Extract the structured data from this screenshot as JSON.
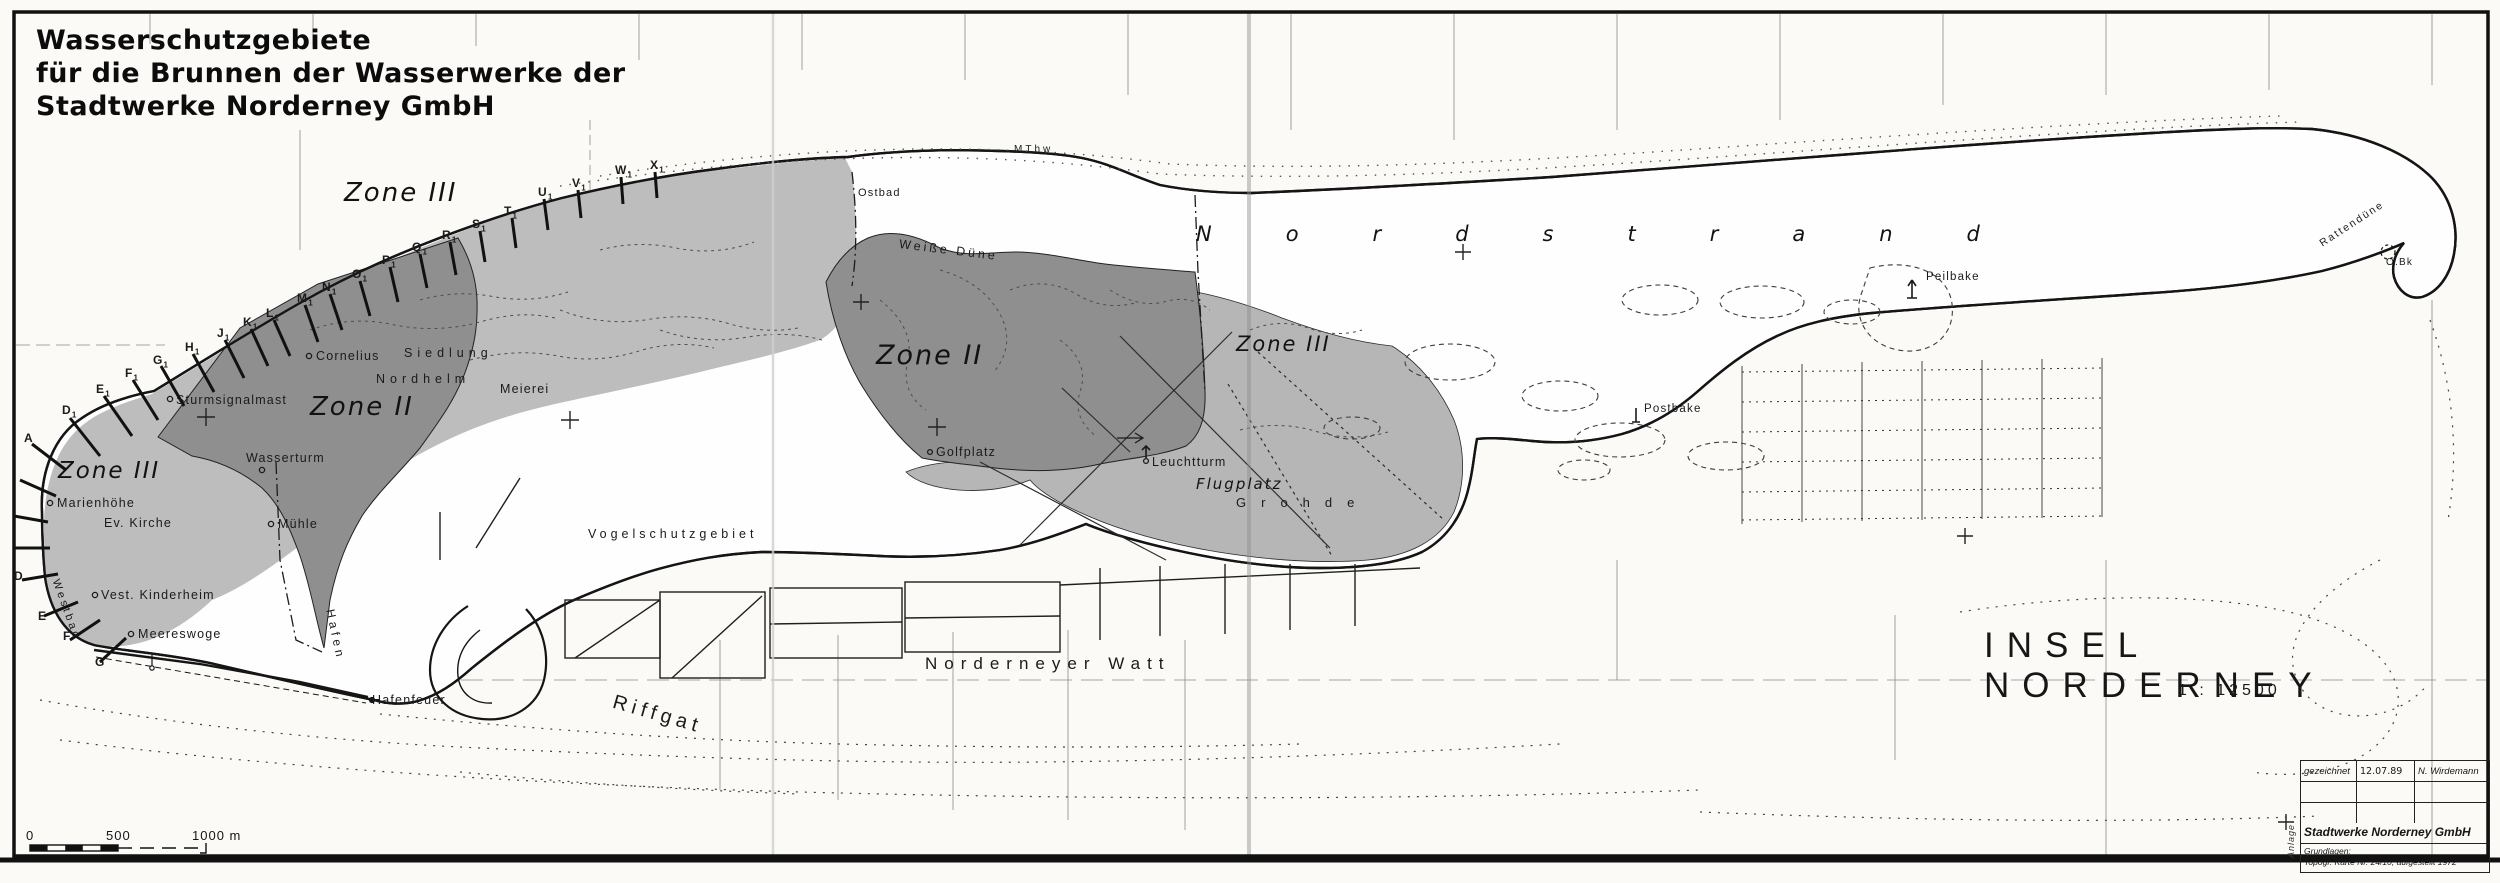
{
  "title": {
    "line1": "Wasserschutzgebiete",
    "line2": "für die Brunnen der Wasserwerke der",
    "line3": "Stadtwerke Norderney GmbH"
  },
  "map_title": {
    "name": "INSEL NORDERNEY",
    "scale": "1 : 12500"
  },
  "scale_bar": {
    "t0": "0",
    "t500": "500",
    "t1000": "1000 m"
  },
  "legend_table": {
    "row1_label": "gezeichnet",
    "row1_date": "12.07.89",
    "row1_name": "N. Wirdemann",
    "company": "Stadtwerke Norderney GmbH",
    "grundlagen": "Grundlagen:",
    "source": "Topogr. Karte Nr. 24/10, aufgestellt 1972",
    "anlage": "Anlage"
  },
  "colors": {
    "zone_ii": "#8f8f8f",
    "zone_iii_west": "#bdbdbd",
    "zone_iii_east": "#b6b6b6",
    "island_fill": "#fefefe",
    "outline": "#151515"
  },
  "map_labels": [
    {
      "name": "zone-iii-west-label",
      "text": "Zone III",
      "x": 58,
      "y": 460,
      "cls": "zone",
      "fs": 23
    },
    {
      "name": "zone-ii-west-label",
      "text": "Zone II",
      "x": 310,
      "y": 394,
      "cls": "zone",
      "fs": 26
    },
    {
      "name": "zone-iii-central-label",
      "text": "Zone III",
      "x": 344,
      "y": 180,
      "cls": "zone",
      "fs": 26
    },
    {
      "name": "zone-ii-central-label",
      "text": "Zone II",
      "x": 876,
      "y": 342,
      "cls": "zone",
      "fs": 27
    },
    {
      "name": "zone-iii-east-label",
      "text": "Zone III",
      "x": 1236,
      "y": 334,
      "cls": "zone",
      "fs": 21
    },
    {
      "name": "marienhoehe-label",
      "text": "Marienhöhe",
      "x": 57,
      "y": 497
    },
    {
      "name": "ev-kirche-label",
      "text": "Ev. Kirche",
      "x": 104,
      "y": 517
    },
    {
      "name": "sturmsignalmast-label",
      "text": "Sturmsignalmast",
      "x": 176,
      "y": 394
    },
    {
      "name": "wasserturm-label",
      "text": "Wasserturm",
      "x": 246,
      "y": 452
    },
    {
      "name": "muehle-label",
      "text": "Mühle",
      "x": 278,
      "y": 518
    },
    {
      "name": "kinderheim-label",
      "text": "Vest. Kinderheim",
      "x": 101,
      "y": 589
    },
    {
      "name": "meereswoge-label",
      "text": "Meereswoge",
      "x": 138,
      "y": 628
    },
    {
      "name": "hafen-label",
      "text": "Hafen",
      "x": 336,
      "y": 608,
      "rot": 78,
      "ls": 4,
      "fs": 12
    },
    {
      "name": "hafenfeuer-label",
      "text": "Hafenfeuer",
      "x": 372,
      "y": 694
    },
    {
      "name": "westbad-label",
      "text": "Westbad",
      "x": 60,
      "y": 578,
      "rot": 70,
      "fs": 11,
      "ls": 3
    },
    {
      "name": "cornelius-label",
      "text": "Cornelius",
      "x": 316,
      "y": 350
    },
    {
      "name": "siedlung-label",
      "text": "Siedlung",
      "x": 404,
      "y": 347,
      "ls": 5
    },
    {
      "name": "nordhelm-label",
      "text": "Nordhelm",
      "x": 376,
      "y": 373,
      "ls": 5
    },
    {
      "name": "meierei-label",
      "text": "Meierei",
      "x": 500,
      "y": 383
    },
    {
      "name": "ostbad-label",
      "text": "Ostbad",
      "x": 858,
      "y": 188,
      "fs": 11
    },
    {
      "name": "mthw-label",
      "text": "MThw",
      "x": 1014,
      "y": 145,
      "fs": 10,
      "ls": 3
    },
    {
      "name": "weisse-duene-label",
      "text": "Weiße Düne",
      "x": 900,
      "y": 238,
      "ls": 3,
      "rot": 7
    },
    {
      "name": "golfplatz-label",
      "text": "Golfplatz",
      "x": 936,
      "y": 446
    },
    {
      "name": "leuchtturm-label",
      "text": "Leuchtturm",
      "x": 1152,
      "y": 456
    },
    {
      "name": "flugplatz-label",
      "text": "Flugplatz",
      "x": 1196,
      "y": 477,
      "cls": "zone",
      "fs": 15
    },
    {
      "name": "grohde-label",
      "text": "Grohde",
      "x": 1236,
      "y": 496,
      "fs": 13,
      "ls": 15
    },
    {
      "name": "vogelschutzgebiet-label",
      "text": "Vogelschutzgebiet",
      "x": 588,
      "y": 528,
      "ls": 4
    },
    {
      "name": "norderneyer-watt-label",
      "text": "Norderneyer Watt",
      "x": 925,
      "y": 655,
      "fs": 17,
      "ls": 7
    },
    {
      "name": "riffgat-label",
      "text": "Riffgat",
      "x": 616,
      "y": 692,
      "fs": 20,
      "ls": 5,
      "rot": 16
    },
    {
      "name": "nordstrand-label",
      "text": "Nordstrand",
      "x": 1196,
      "y": 224,
      "cls": "zone",
      "fs": 21,
      "ls": 74
    },
    {
      "name": "peilbake-label",
      "text": "Peilbake",
      "x": 1926,
      "y": 272,
      "fs": 11.5
    },
    {
      "name": "postbake-label",
      "text": "Postbake",
      "x": 1644,
      "y": 404,
      "fs": 11.5
    },
    {
      "name": "rattenduene-label",
      "text": "Rattendüne",
      "x": 2318,
      "y": 240,
      "fs": 10.5,
      "rot": -33,
      "ls": 2
    },
    {
      "name": "obk-label",
      "text": "O.Bk",
      "x": 2386,
      "y": 258,
      "fs": 10
    }
  ],
  "groynes_northwest": [
    {
      "t": "D",
      "s": "1",
      "x": 62,
      "y": 404
    },
    {
      "t": "E",
      "s": "1",
      "x": 96,
      "y": 383
    },
    {
      "t": "F",
      "s": "1",
      "x": 125,
      "y": 367
    },
    {
      "t": "G",
      "s": "1",
      "x": 153,
      "y": 354
    },
    {
      "t": "H",
      "s": "1",
      "x": 185,
      "y": 341
    },
    {
      "t": "J",
      "s": "1",
      "x": 217,
      "y": 327
    },
    {
      "t": "K",
      "s": "1",
      "x": 243,
      "y": 316
    },
    {
      "t": "L",
      "s": "1",
      "x": 266,
      "y": 307
    },
    {
      "t": "M",
      "s": "1",
      "x": 297,
      "y": 292
    },
    {
      "t": "N",
      "s": "1",
      "x": 322,
      "y": 281
    },
    {
      "t": "O",
      "s": "1",
      "x": 352,
      "y": 268
    },
    {
      "t": "P",
      "s": "1",
      "x": 382,
      "y": 254
    },
    {
      "t": "Q",
      "s": "1",
      "x": 412,
      "y": 241
    },
    {
      "t": "R",
      "s": "1",
      "x": 442,
      "y": 229
    },
    {
      "t": "S",
      "s": "1",
      "x": 472,
      "y": 218
    },
    {
      "t": "T",
      "s": "1",
      "x": 504,
      "y": 205
    },
    {
      "t": "U",
      "s": "1",
      "x": 538,
      "y": 186
    },
    {
      "t": "V",
      "s": "1",
      "x": 572,
      "y": 177
    },
    {
      "t": "W",
      "s": "1",
      "x": 615,
      "y": 164
    },
    {
      "t": "X",
      "s": "1",
      "x": 650,
      "y": 159
    }
  ],
  "groynes_west": [
    {
      "t": "A",
      "s": "",
      "x": 24,
      "y": 432
    },
    {
      "t": "D",
      "s": "",
      "x": 14,
      "y": 570
    },
    {
      "t": "E",
      "s": "",
      "x": 38,
      "y": 610
    },
    {
      "t": "F",
      "s": "",
      "x": 63,
      "y": 630
    },
    {
      "t": "G",
      "s": "",
      "x": 95,
      "y": 656
    }
  ]
}
